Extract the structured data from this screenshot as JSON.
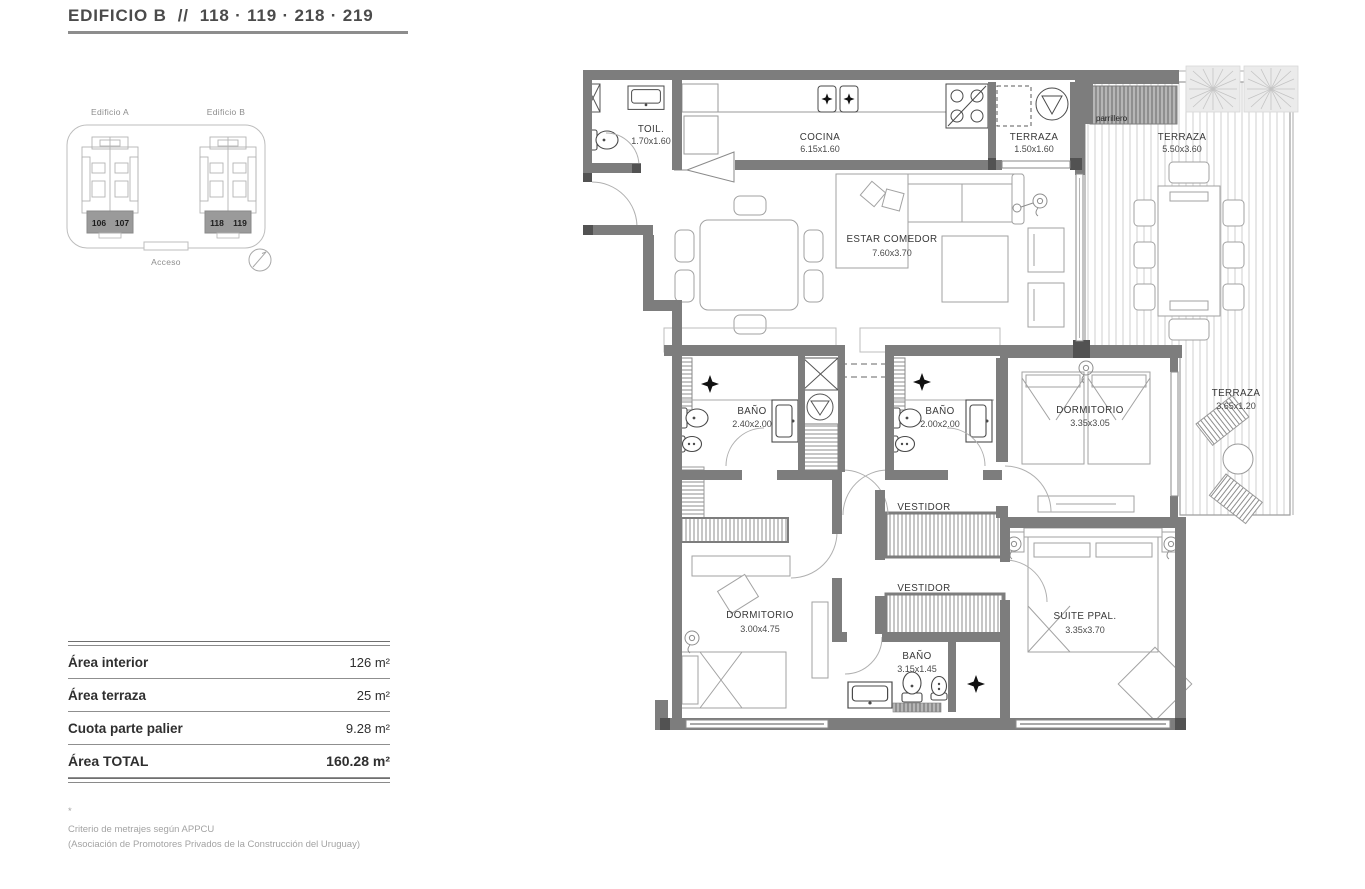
{
  "header": {
    "title": "EDIFICIO B  //  118 · 119 · 218 · 219"
  },
  "locator": {
    "building_a": {
      "label": "Edificio A",
      "units": [
        "106",
        "107"
      ]
    },
    "building_b": {
      "label": "Edificio B",
      "units": [
        "118",
        "119"
      ]
    },
    "access_label": "Acceso"
  },
  "plan": {
    "rooms": [
      {
        "name": "TOIL.",
        "dims": "1.70x1.60"
      },
      {
        "name": "COCINA",
        "dims": "6.15x1.60"
      },
      {
        "name": "TERRAZA",
        "dims": "1.50x1.60"
      },
      {
        "name": "TERRAZA",
        "dims": "5.50x3.60"
      },
      {
        "name": "ESTAR COMEDOR",
        "dims": "7.60x3.70"
      },
      {
        "name": "BAÑO",
        "dims": "2.40x2.00"
      },
      {
        "name": "BAÑO",
        "dims": "2.00x2.00"
      },
      {
        "name": "DORMITORIO",
        "dims": "3.35x3.05"
      },
      {
        "name": "TERRAZA",
        "dims": "3.65x1.20"
      },
      {
        "name": "VESTIDOR",
        "dims": ""
      },
      {
        "name": "VESTIDOR",
        "dims": ""
      },
      {
        "name": "DORMITORIO",
        "dims": "3.00x4.75"
      },
      {
        "name": "SUITE PPAL.",
        "dims": "3.35x3.70"
      },
      {
        "name": "BAÑO",
        "dims": "3.15x1.45"
      }
    ],
    "parrillero_label": "parrillero"
  },
  "areas": {
    "rows": [
      {
        "label": "Área interior",
        "value": "126 m²"
      },
      {
        "label": "Área terraza",
        "value": "25 m²"
      },
      {
        "label": "Cuota parte palier",
        "value": "9.28 m²"
      },
      {
        "label": "Área TOTAL",
        "value": "160.28 m²"
      }
    ],
    "footnote_mark": "*",
    "footnote_line1": "Criterio de metrajes según APPCU",
    "footnote_line2": "(Asociación de Promotores Privados de la Construcción del Uruguay)"
  },
  "colors": {
    "wall": "#7d7d7d",
    "wall_cap": "#525252",
    "deck_line": "#cfcfcf",
    "text": "#3c3c3c"
  }
}
